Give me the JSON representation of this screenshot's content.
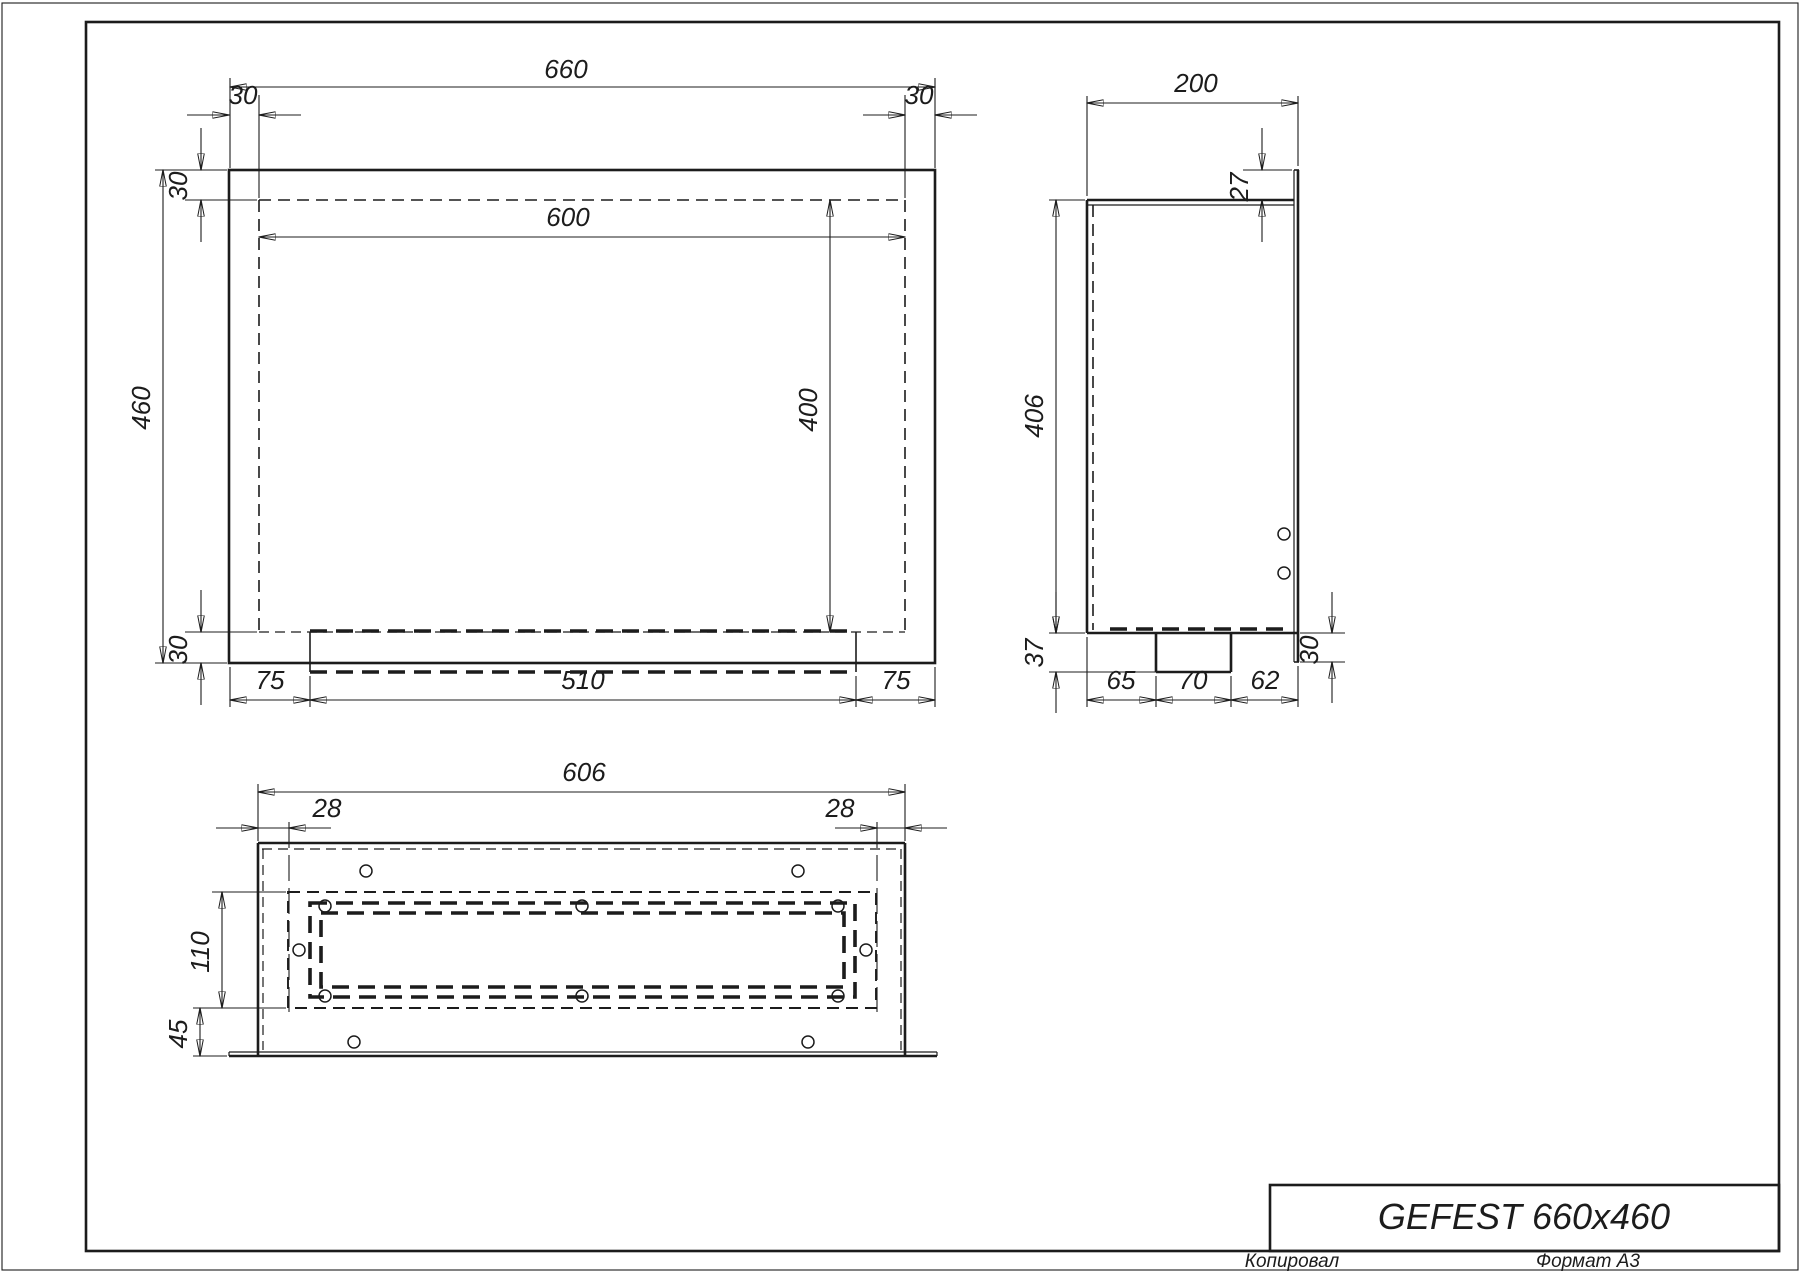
{
  "title_block": {
    "product": "GEFEST 660x460",
    "copied": "Копировал",
    "format": "Формат A3"
  },
  "front_view": {
    "overall_width": "660",
    "flange_left": "30",
    "flange_right": "30",
    "inner_width": "600",
    "overall_height": "460",
    "top_inset": "30",
    "bottom_inset": "30",
    "inner_height": "400",
    "tray_left_offset": "75",
    "tray_width": "510",
    "tray_right_offset": "75"
  },
  "side_view": {
    "depth": "200",
    "front_lip": "27",
    "body_height": "406",
    "tray_depth": "37",
    "tray_front_offset": "65",
    "tray_width": "70",
    "tray_back_offset": "62",
    "lip_bottom": "30"
  },
  "bottom_view": {
    "width": "606",
    "side_inset_left": "28",
    "side_inset_right": "28",
    "opening_height": "110",
    "front_strip": "45"
  }
}
